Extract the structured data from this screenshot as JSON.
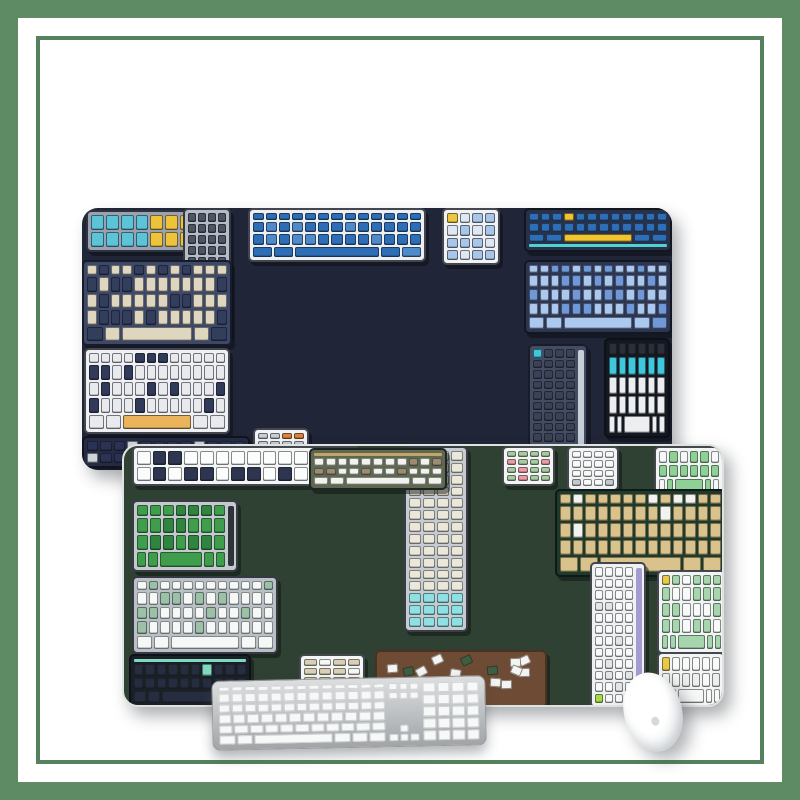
{
  "scene": {
    "width": 800,
    "height": 800,
    "background": "#ffffff",
    "frame": {
      "outer_color": "#5e8a64",
      "outer_thickness": 18,
      "line_color": "#55815c",
      "line_thickness": 4,
      "line_inset": 36
    },
    "pads": [
      {
        "id": "navy",
        "name": "navy-keyboard-mousepad",
        "x": 82,
        "y": 208,
        "w": 590,
        "h": 262,
        "bg": "#202637",
        "radius": 16,
        "kb_outline": "rgba(14,18,30,0.55)",
        "kb_shadow": "3px 4px 0 rgba(8,10,16,0.45)",
        "shadow": "7px 9px 16px rgba(40,46,52,0.38)"
      },
      {
        "id": "green",
        "name": "green-keyboard-mousepad",
        "x": 122,
        "y": 444,
        "w": 602,
        "h": 263,
        "bg": "#2f4133",
        "radius": 16,
        "rim": "#dfe3df",
        "kb_outline": "rgba(20,28,20,0.5)",
        "kb_shadow": "3px 4px 0 rgba(12,20,14,0.5)",
        "shadow": "7px 9px 16px rgba(40,46,52,0.38)"
      }
    ],
    "keyboards": [
      {
        "pad": "navy",
        "name": "kb-cyan-yellow",
        "x": 86,
        "y": 210,
        "w": 112,
        "h": 42,
        "case": "#99a1b2",
        "key": "#5cc4d6",
        "alt": "#edc33c",
        "alt_mode": "right",
        "rows": 2,
        "cols": 7
      },
      {
        "pad": "navy",
        "name": "kb-vertical-silver",
        "x": 183,
        "y": 208,
        "w": 48,
        "h": 130,
        "style": "v",
        "case": "#b5bbc7",
        "key": "#4e5560",
        "alt": "#2f80ba",
        "alt_mode": "bottom",
        "rows": 11,
        "cols": 4
      },
      {
        "pad": "navy",
        "name": "kb-white-blue",
        "x": 248,
        "y": 208,
        "w": 178,
        "h": 54,
        "case": "#edeff2",
        "key": "#2e6eb6",
        "alt": "#4f8aca",
        "alt_mode": "scatter",
        "alt_ratio": 0.2,
        "rows": 4,
        "cols": 13
      },
      {
        "pad": "navy",
        "name": "kb-numpad-blue",
        "x": 442,
        "y": 208,
        "w": 58,
        "h": 57,
        "style": "numpad",
        "case": "#f1f2f4",
        "key": "#a9c6e8",
        "alt": "#dfe7f2",
        "alt_mode": "scatter",
        "alt_ratio": 0.3,
        "accent": "#edc63e"
      },
      {
        "pad": "navy",
        "name": "kb-navy-blue-yellow",
        "x": 524,
        "y": 208,
        "w": 148,
        "h": 44,
        "case": "#2a3046",
        "key": "#2e6eb6",
        "alt": "#f0c330",
        "alt_mode": "scatter",
        "alt_ratio": 0.08,
        "rows": 3,
        "cols": 12,
        "space": "#f0c330",
        "strip": "#4ed2d6",
        "strip_pos": "bottom"
      },
      {
        "pad": "navy",
        "name": "kb-periwinkle",
        "x": 524,
        "y": 260,
        "w": 148,
        "h": 74,
        "case": "#2d3550",
        "key": "#abc8ee",
        "alt": "#7097d6",
        "alt_mode": "scatter",
        "alt_ratio": 0.3,
        "rows": 5,
        "cols": 13
      },
      {
        "pad": "navy",
        "name": "kb-beige-navy",
        "x": 82,
        "y": 260,
        "w": 150,
        "h": 86,
        "case": "#3d4768",
        "key": "#ded6be",
        "alt": "#333d5c",
        "alt_mode": "scatter",
        "alt_ratio": 0.35,
        "rows": 5,
        "cols": 12
      },
      {
        "pad": "navy",
        "name": "kb-white-orange",
        "x": 84,
        "y": 348,
        "w": 146,
        "h": 86,
        "case": "#eff0f3",
        "key": "#e9eaed",
        "alt": "#313b59",
        "alt_mode": "scatter",
        "alt_ratio": 0.3,
        "rows": 5,
        "cols": 12,
        "space": "#eab45c"
      },
      {
        "pad": "navy",
        "name": "kb-dark-navy",
        "x": 82,
        "y": 436,
        "w": 168,
        "h": 32,
        "case": "#252b40",
        "key": "#2c3254",
        "alt": "#cfd3da",
        "alt_mode": "scatter",
        "alt_ratio": 0.15,
        "rows": 2,
        "cols": 12
      },
      {
        "pad": "navy",
        "name": "kb-numpad-multi",
        "x": 253,
        "y": 428,
        "w": 56,
        "h": 40,
        "style": "numpad",
        "case": "#f3f4f6",
        "key": "#c9ced6",
        "alt": "#e2833c",
        "alt_mode": "scatter",
        "alt_ratio": 0.25
      },
      {
        "pad": "navy",
        "name": "kb-vertical-dark",
        "x": 528,
        "y": 344,
        "w": 60,
        "h": 124,
        "style": "v",
        "case": "#444c63",
        "key": "#3a4253",
        "alt": "#3a4253",
        "accent": "#3fc8dc",
        "rail": "#c8ced8",
        "rows": 11,
        "cols": 4
      },
      {
        "pad": "navy",
        "name": "kb-black-cyan",
        "x": 604,
        "y": 338,
        "w": 66,
        "h": 100,
        "case": "#15181f",
        "key": "#eceef0",
        "alt": "#3fc8dc",
        "alt_mode": "row1",
        "rows": 5,
        "cols": 6,
        "top_row": "#2b2f3a"
      },
      {
        "pad": "green",
        "name": "kb-white-sparse",
        "x": 130,
        "y": 444,
        "w": 228,
        "h": 40,
        "case": "#f4f5f6",
        "key": "#fbfcfc",
        "alt": "#2d3550",
        "alt_mode": "scatter",
        "alt_ratio": 0.25,
        "rows": 2,
        "cols": 14
      },
      {
        "pad": "green",
        "name": "kb-vertical-cream",
        "x": 402,
        "y": 444,
        "w": 64,
        "h": 186,
        "style": "v",
        "case": "#c6cbd4",
        "key": "#ebe7da",
        "alt": "#8ee0e2",
        "alt_mode": "bottom",
        "rows": 15,
        "cols": 4
      },
      {
        "pad": "green",
        "name": "kb-numpad-sage",
        "x": 500,
        "y": 444,
        "w": 53,
        "h": 40,
        "style": "numpad",
        "case": "#f3f4f5",
        "key": "#a9c9a2",
        "alt": "#e89aa6",
        "alt_mode": "scatter",
        "alt_ratio": 0.15
      },
      {
        "pad": "green",
        "name": "kb-numpad-white",
        "x": 565,
        "y": 444,
        "w": 52,
        "h": 45,
        "style": "numpad",
        "case": "#f2f3f4",
        "key": "#f8f9fa",
        "alt": "#c2c8ce",
        "alt_mode": "scatter",
        "alt_ratio": 0.2
      },
      {
        "pad": "green",
        "name": "kb-green-white",
        "x": 652,
        "y": 444,
        "w": 70,
        "h": 50,
        "case": "#f2f3f5",
        "key": "#8fd096",
        "alt": "#f6f7f8",
        "alt_mode": "scatter",
        "alt_ratio": 0.4,
        "rows": 3,
        "cols": 6
      },
      {
        "pad": "green",
        "name": "kb-white-taupe",
        "x": 307,
        "y": 446,
        "w": 138,
        "h": 42,
        "case": "#5e6850",
        "key": "#f2f2ee",
        "alt": "#9b8a74",
        "alt_mode": "scatter",
        "alt_ratio": 0.3,
        "rows": 3,
        "cols": 11,
        "strip": "#c2a368",
        "strip_pos": "top"
      },
      {
        "pad": "green",
        "name": "kb-green-keys",
        "x": 130,
        "y": 498,
        "w": 106,
        "h": 72,
        "case": "#c4cacf",
        "key": "#3f9e4c",
        "alt": "#2f8440",
        "alt_mode": "scatter",
        "alt_ratio": 0.3,
        "rows": 4,
        "cols": 7,
        "rail": "#2e3438"
      },
      {
        "pad": "green",
        "name": "kb-tan-green",
        "x": 553,
        "y": 487,
        "w": 171,
        "h": 88,
        "case": "#203a2a",
        "key": "#dac28d",
        "alt": "#f2f2ef",
        "alt_mode": "scatter",
        "alt_ratio": 0.12,
        "rows": 5,
        "cols": 13
      },
      {
        "pad": "green",
        "name": "kb-silver-sage",
        "x": 130,
        "y": 574,
        "w": 146,
        "h": 78,
        "case": "#b9c0c7",
        "key": "#f6f7f7",
        "alt": "#9cc0a8",
        "alt_mode": "scatter",
        "alt_ratio": 0.28,
        "rows": 5,
        "cols": 12
      },
      {
        "pad": "green",
        "name": "kb-mint-white",
        "x": 655,
        "y": 568,
        "w": 69,
        "h": 84,
        "case": "#f2f3f5",
        "key": "#a6d5ae",
        "alt": "#f8f9f9",
        "alt_mode": "scatter",
        "alt_ratio": 0.3,
        "rows": 5,
        "cols": 6,
        "accent": "#e8c94c"
      },
      {
        "pad": "green",
        "name": "kb-dark-mint",
        "x": 127,
        "y": 652,
        "w": 122,
        "h": 54,
        "case": "#1b1f26",
        "key": "#272d40",
        "alt": "#7fd8c2",
        "alt_mode": "scatter",
        "alt_ratio": 0.06,
        "rows": 3,
        "cols": 10,
        "strip": "#7fd8c2",
        "strip_pos": "top"
      },
      {
        "pad": "green",
        "name": "kb-numpad-beige",
        "x": 297,
        "y": 652,
        "w": 66,
        "h": 44,
        "style": "numpad",
        "case": "#f4f5f6",
        "key": "#d8cfb6",
        "alt": "#f6f6f4",
        "alt_mode": "scatter",
        "alt_ratio": 0.3
      },
      {
        "pad": "green",
        "name": "kb-keycap-crate",
        "x": 373,
        "y": 648,
        "w": 172,
        "h": 58,
        "style": "crate",
        "case": "#6e4b34",
        "edge": "#4a3122",
        "key": "#f4f4f2",
        "alt": "#3e5d42"
      },
      {
        "pad": "green",
        "name": "kb-vertical-white",
        "x": 588,
        "y": 560,
        "w": 56,
        "h": 146,
        "style": "v",
        "case": "#eef0f2",
        "key": "#f8f9fa",
        "alt": "#e3e6e9",
        "alt_mode": "scatter",
        "alt_ratio": 0.2,
        "rows": 12,
        "cols": 4,
        "rail": "#a49cd0",
        "accent": "#a8d84c",
        "accent_pos": "bl"
      },
      {
        "pad": "green",
        "name": "kb-yellow-corner",
        "x": 655,
        "y": 650,
        "w": 68,
        "h": 56,
        "case": "#f3f4f5",
        "key": "#f8f9f9",
        "alt": "#eceeef",
        "alt_mode": "scatter",
        "alt_ratio": 0.2,
        "rows": 3,
        "cols": 6,
        "accent": "#e8c94c"
      }
    ],
    "desk_keyboard": {
      "name": "aluminum-desk-keyboard",
      "x": 212,
      "y": 678,
      "w": 274,
      "h": 70,
      "rotate": -1.2,
      "case_top": "#dcdedf",
      "case_mid": "#bcbfc1",
      "case_bottom": "#a2a5a8",
      "edge": "#97999c",
      "key": "#f7f8f8",
      "key_edge": "#ced1d3",
      "fn_keys": 13,
      "main_rows": [
        13,
        13,
        12,
        11
      ],
      "bottom_left": 2,
      "bottom_right": 3,
      "nav_keys_per_row": 3,
      "nav_rows": 2,
      "num_cols": 4,
      "num_rows": 5,
      "shadow": "0 7px 12px rgba(70,76,82,0.42)"
    },
    "mouse": {
      "name": "white-mouse",
      "x": 624,
      "y": 672,
      "w": 58,
      "h": 80,
      "rotate": -14,
      "body": "#ffffff",
      "mid": "#f2f4f5",
      "shade": "#d6dadd",
      "logo": "#c4c8cb",
      "shadow": "6px 10px 16px rgba(60,66,72,0.4)"
    }
  }
}
